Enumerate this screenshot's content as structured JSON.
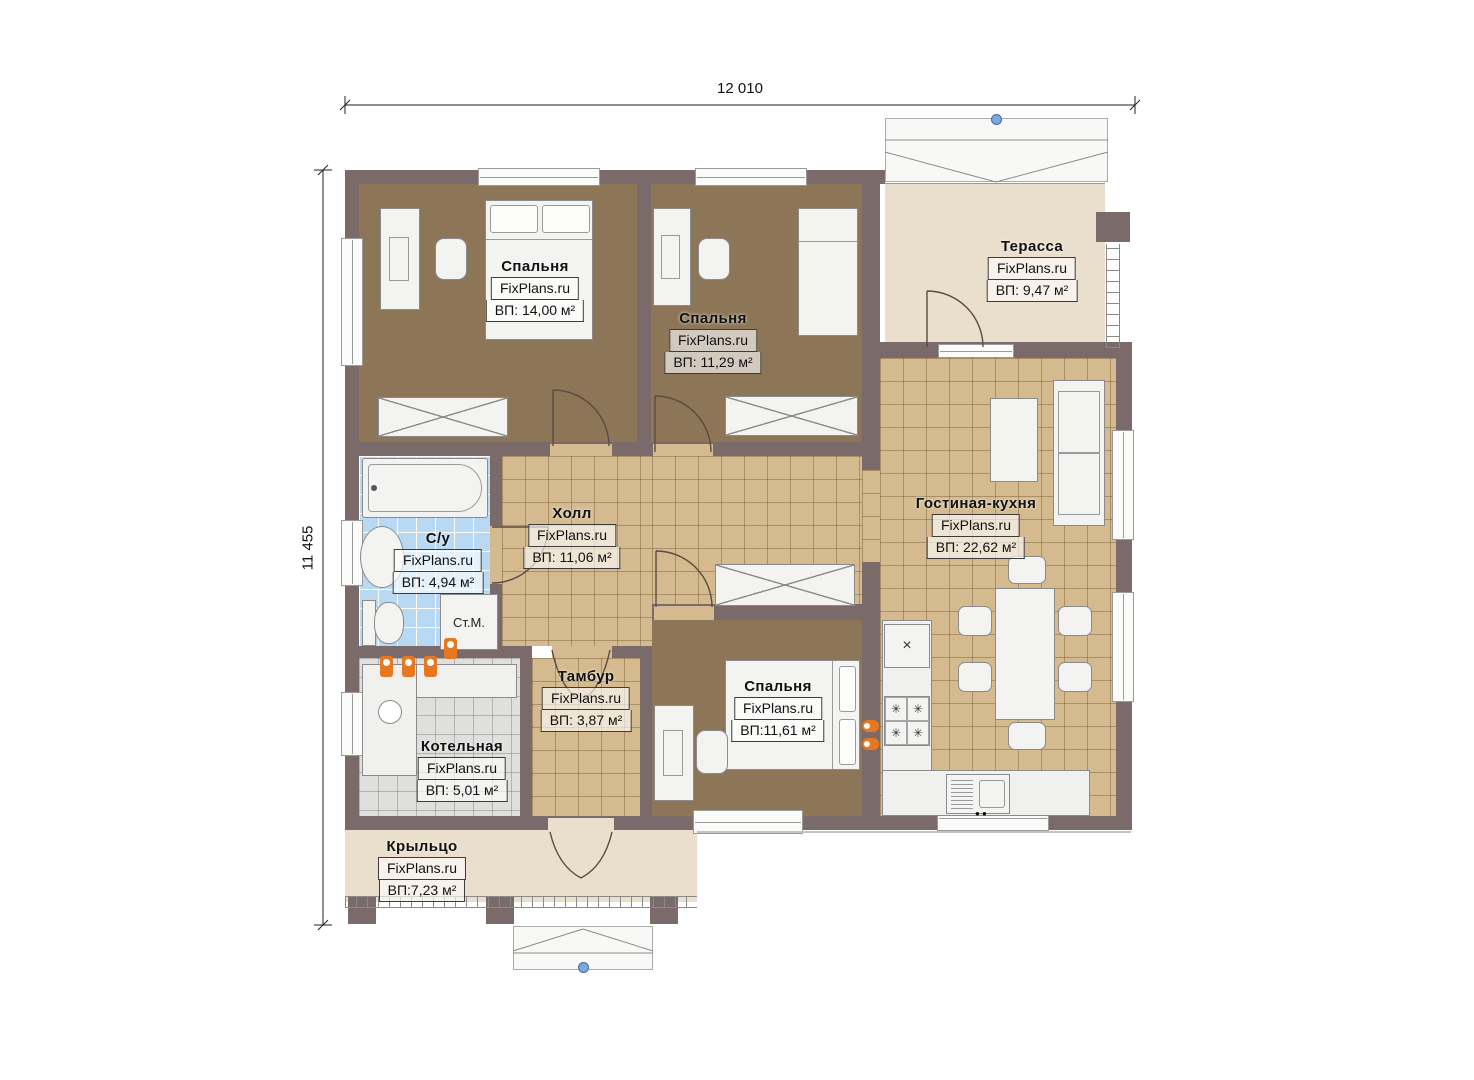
{
  "dimensions": {
    "top": "12 010",
    "left": "11 455"
  },
  "rooms": [
    {
      "key": "bedroom-1",
      "name": "Спальня",
      "brand": "FixPlans.ru",
      "area": "ВП: 14,00 м²"
    },
    {
      "key": "bedroom-2",
      "name": "Спальня",
      "brand": "FixPlans.ru",
      "area": "ВП: 11,29 м²"
    },
    {
      "key": "terrace",
      "name": "Терасса",
      "brand": "FixPlans.ru",
      "area": "ВП: 9,47 м²"
    },
    {
      "key": "hall",
      "name": "Холл",
      "brand": "FixPlans.ru",
      "area": "ВП: 11,06 м²"
    },
    {
      "key": "bathroom",
      "name": "С/у",
      "brand": "FixPlans.ru",
      "area": "ВП: 4,94 м²"
    },
    {
      "key": "living-kitchen",
      "name": "Гостиная-кухня",
      "brand": "FixPlans.ru",
      "area": "ВП: 22,62 м²"
    },
    {
      "key": "tambour",
      "name": "Тамбур",
      "brand": "FixPlans.ru",
      "area": "ВП: 3,87 м²"
    },
    {
      "key": "boiler-room",
      "name": "Котельная",
      "brand": "FixPlans.ru",
      "area": "ВП: 5,01 м²"
    },
    {
      "key": "bedroom-3",
      "name": "Спальня",
      "brand": "FixPlans.ru",
      "area": "ВП:11,61 м²"
    },
    {
      "key": "porch",
      "name": "Крыльцо",
      "brand": "FixPlans.ru",
      "area": "ВП:7,23 м²"
    }
  ],
  "labels": {
    "washing_machine": "Ст.М."
  },
  "glyphs": {
    "burner": "✳",
    "vent_unit": "×"
  },
  "colors": {
    "wall": "#7b6a6a",
    "tile_floor": "#d4ba8e",
    "carpet_floor": "#8d7557",
    "bath_tile": "#b9d9f2",
    "boiler_tile": "#dfdfdd",
    "outdoor_floor": "#e9dfcc",
    "equipment_orange": "#e87820",
    "marker_blue": "#7fa8d9"
  }
}
